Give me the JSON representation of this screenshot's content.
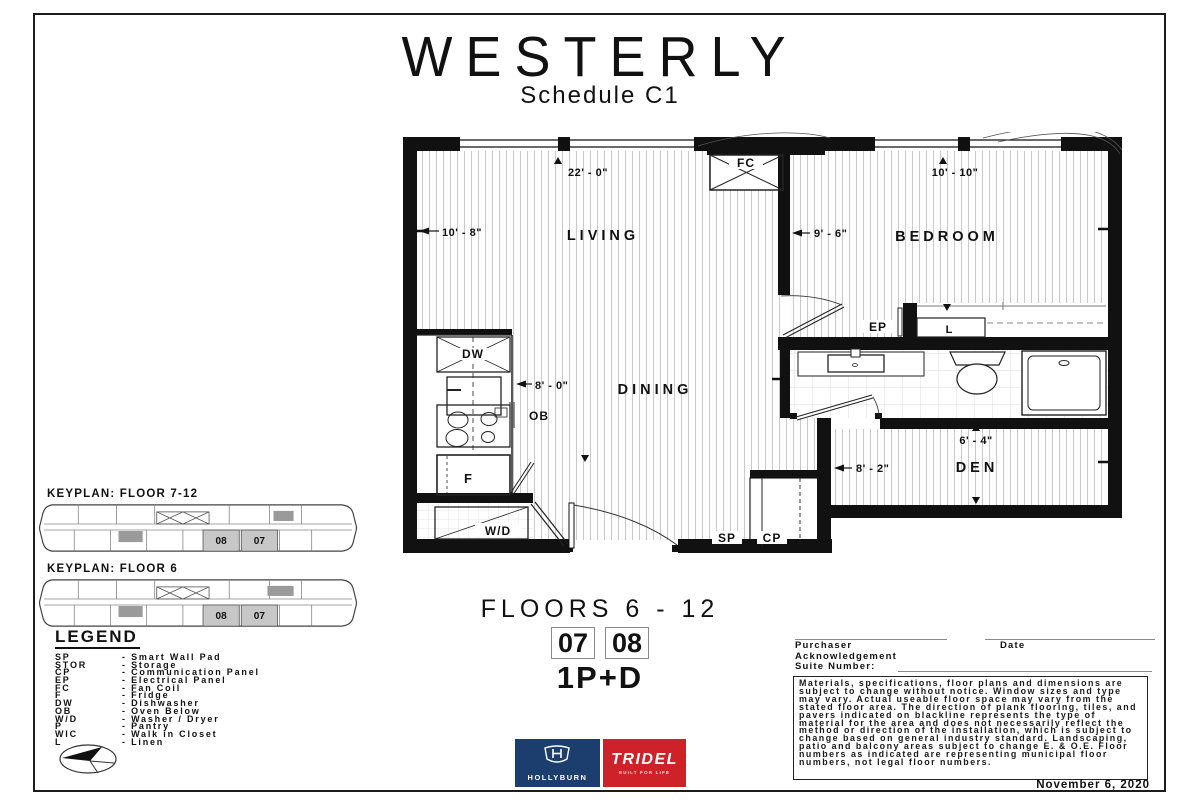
{
  "header": {
    "brand": "WESTERLY",
    "subtitle": "Schedule C1"
  },
  "plan": {
    "rooms": {
      "living": "LIVING",
      "dining": "DINING",
      "bedroom": "BEDROOM",
      "den": "DEN"
    },
    "dims": {
      "living_w": "22' - 0\"",
      "living_d": "10' - 8\"",
      "bedroom_w": "10' - 10\"",
      "bedroom_d": "9' - 6\"",
      "kitchen_w": "8' - 0\"",
      "den_d": "6' - 4\"",
      "den_w": "8' - 2\""
    },
    "tags": {
      "fc": "FC",
      "dw": "DW",
      "ob": "OB",
      "f": "F",
      "wd": "W/D",
      "sp": "SP",
      "cp": "CP",
      "ep": "EP",
      "l": "L"
    }
  },
  "keyplans": [
    {
      "title": "KEYPLAN: FLOOR 7-12",
      "units": {
        "u08": "08",
        "u07": "07"
      }
    },
    {
      "title": "KEYPLAN: FLOOR 6",
      "units": {
        "u08": "08",
        "u07": "07"
      }
    }
  ],
  "legend": {
    "title": "LEGEND",
    "items": [
      {
        "abbr": "SP",
        "label": "- Smart Wall Pad"
      },
      {
        "abbr": "STOR",
        "label": "- Storage"
      },
      {
        "abbr": "CP",
        "label": "- Communication Panel"
      },
      {
        "abbr": "EP",
        "label": "- Electrical Panel"
      },
      {
        "abbr": "FC",
        "label": "- Fan Coil"
      },
      {
        "abbr": "F",
        "label": "- Fridge"
      },
      {
        "abbr": "DW",
        "label": "- Dishwasher"
      },
      {
        "abbr": "OB",
        "label": "- Oven Below"
      },
      {
        "abbr": "W/D",
        "label": "- Washer / Dryer"
      },
      {
        "abbr": "P",
        "label": "- Pantry"
      },
      {
        "abbr": "WIC",
        "label": "- Walk in Closet"
      },
      {
        "abbr": "L",
        "label": "- Linen"
      }
    ]
  },
  "summary": {
    "floors": "FLOORS 6 - 12",
    "unit_left": "07",
    "unit_right": "08",
    "plan_type": "1P+D"
  },
  "ack": {
    "purchaser_line1": "Purchaser",
    "purchaser_line2": "Acknowledgement",
    "date_label": "Date",
    "suite_label": "Suite Number:",
    "disclaimer": "Materials, specifications, floor plans and dimensions are subject to change without notice. Window sizes and type may vary. Actual useable floor space may vary from the stated floor area. The direction of plank flooring, tiles, and pavers indicated on blackline represents the type of material for the area and does not necessarily reflect the method or direction of the installation, which is subject to change based on general industry standard. Landscaping, patio and balcony areas subject to change E. & O.E. Floor numbers as indicated are representing municipal floor numbers, not legal floor numbers.",
    "issue_date": "November 6, 2020"
  },
  "logos": {
    "hollyburn": {
      "name": "HOLLYBURN",
      "color": "#1c3e6e"
    },
    "tridel": {
      "name": "TRIDEL",
      "tagline": "BUILT FOR LIFE",
      "color": "#cf2128"
    }
  }
}
